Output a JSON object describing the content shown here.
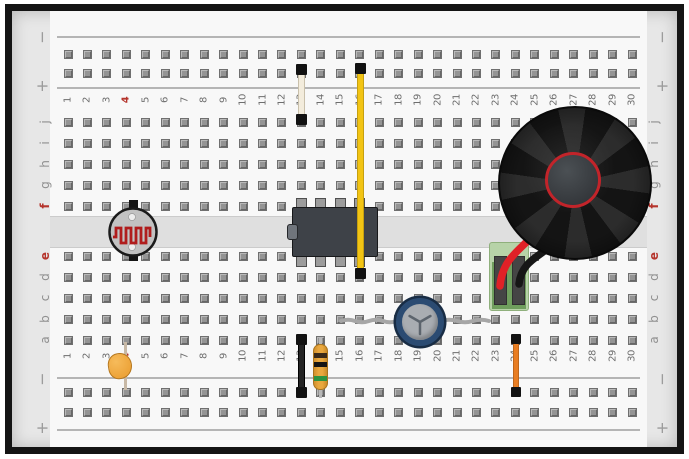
{
  "board": {
    "columns": 30,
    "top_row_letters": [
      "j",
      "i",
      "h",
      "g",
      "f"
    ],
    "bottom_row_letters": [
      "e",
      "d",
      "c",
      "b",
      "a"
    ],
    "highlighted_column": "4",
    "highlighted_rows": [
      "f",
      "e"
    ],
    "rail": {
      "minus": "−",
      "plus": "+"
    }
  },
  "components": [
    {
      "name": "photoresistor",
      "description": "LDR across center channel at column 4, rows f–e"
    },
    {
      "name": "jumper-white",
      "description": "white jumper, column 13, + rail to row j"
    },
    {
      "name": "ic-8pin-dip",
      "description": "8-pin DIP IC across channel, columns 13–16"
    },
    {
      "name": "jumper-yellow",
      "description": "yellow jumper, column 16, + rail to row d, passes over IC"
    },
    {
      "name": "speaker",
      "description": "round speaker, upper right, columns 24–29"
    },
    {
      "name": "speaker-red-wire",
      "description": "red lead into screw terminal column 23"
    },
    {
      "name": "speaker-black-wire",
      "description": "black lead into screw terminal column 24"
    },
    {
      "name": "screw-terminal",
      "description": "green 2-pin screw terminal, columns 23–24, rows e–c"
    },
    {
      "name": "electrolytic-capacitor",
      "description": "blue top-view capacitor at column 19, leads along row b columns 15–23"
    },
    {
      "name": "jumper-black",
      "description": "black jumper, column 13, row a to − rail"
    },
    {
      "name": "resistor",
      "description": "resistor with dark-dark-green bands, column 14, row a to − rail"
    },
    {
      "name": "ceramic-capacitor",
      "description": "orange ceramic capacitor, column 4, row a to − rail"
    },
    {
      "name": "jumper-orange",
      "description": "orange jumper, column 24, row a to − rail"
    }
  ],
  "colors": {
    "board_margin": "#e7e7e7",
    "panel": "#f8f8f8",
    "channel": "#dfdfdf",
    "hole": "#949494",
    "rail_line": "#b5b5b5",
    "number": "#6e6e6e",
    "letter": "#8f8f8f",
    "label_red": "#b5342c",
    "wire_yellow": "#f2c414",
    "wire_white": "#f3ecdc",
    "wire_black": "#242424",
    "wire_orange": "#e87d22",
    "wire_red": "#e02127",
    "cap_black": "#121212",
    "ic_body": "#3e4248",
    "ic_pin": "#9c9c9c",
    "resistor_body": "#e9a83f",
    "band_brown": "#3a2a1a",
    "band_black": "#141414",
    "band_green": "#2e9440",
    "ceramic_cap": "#eda43a",
    "ecap_ring": "#2b4b72",
    "ecap_face": "#a9adb2",
    "lead_gray": "#a6a6a6",
    "ldr_body": "#c2c2c2",
    "ldr_trace": "#b01c1c",
    "speaker_dark": "#141414",
    "speaker_swirl": "#2c2c2c",
    "speaker_ring": "#c2242a",
    "terminal_light": "#b7d3a8",
    "terminal_dark": "#6f9e5d",
    "terminal_slot": "#454545"
  }
}
